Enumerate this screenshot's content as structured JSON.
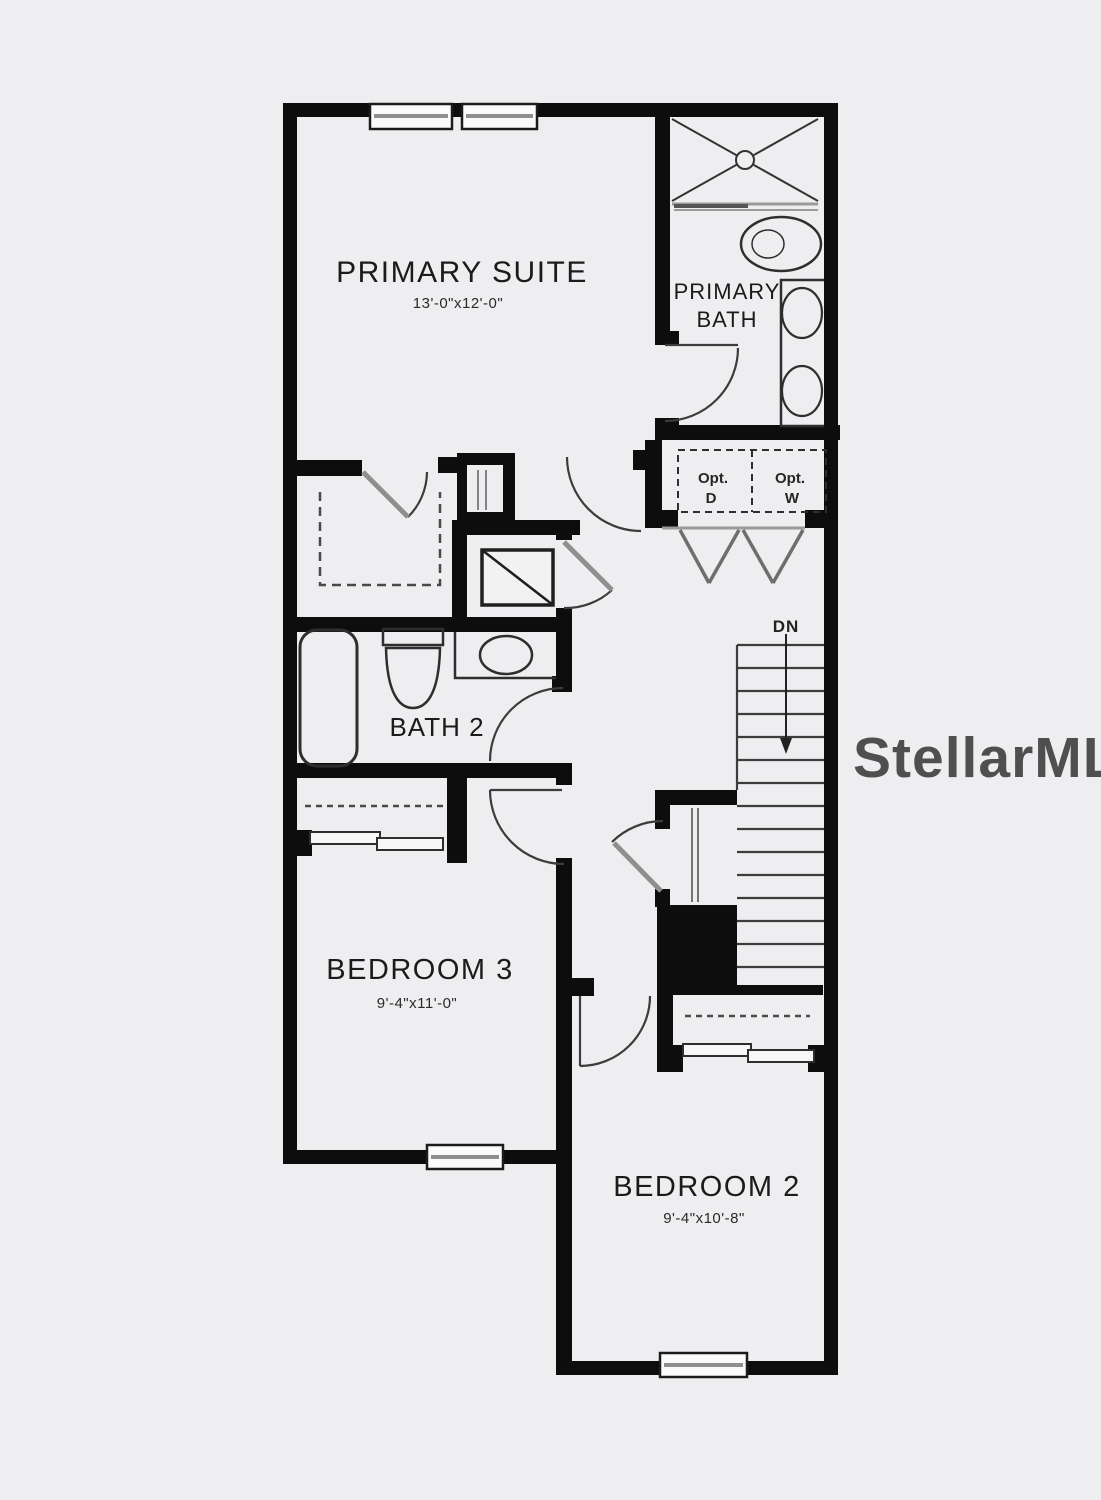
{
  "canvas": {
    "background": "#eeeef0",
    "wall_color": "#0d0d0d",
    "line_color": "#3c3c3c",
    "door_leaf_color": "#8f8f8f"
  },
  "watermark": {
    "text": "StellarMLS",
    "color": "#ffffff"
  },
  "rooms": {
    "primary_suite": {
      "name": "PRIMARY SUITE",
      "dimensions": "13'-0\"x12'-0\""
    },
    "primary_bath": {
      "name_line1": "PRIMARY",
      "name_line2": "BATH"
    },
    "bath_2": {
      "name": "BATH 2"
    },
    "bedroom_3": {
      "name": "BEDROOM 3",
      "dimensions": "9'-4\"x11'-0\""
    },
    "bedroom_2": {
      "name": "BEDROOM 2",
      "dimensions": "9'-4\"x10'-8\""
    }
  },
  "labels": {
    "stairs_down": "DN",
    "opt_dryer_line1": "Opt.",
    "opt_dryer_line2": "D",
    "opt_washer_line1": "Opt.",
    "opt_washer_line2": "W"
  }
}
